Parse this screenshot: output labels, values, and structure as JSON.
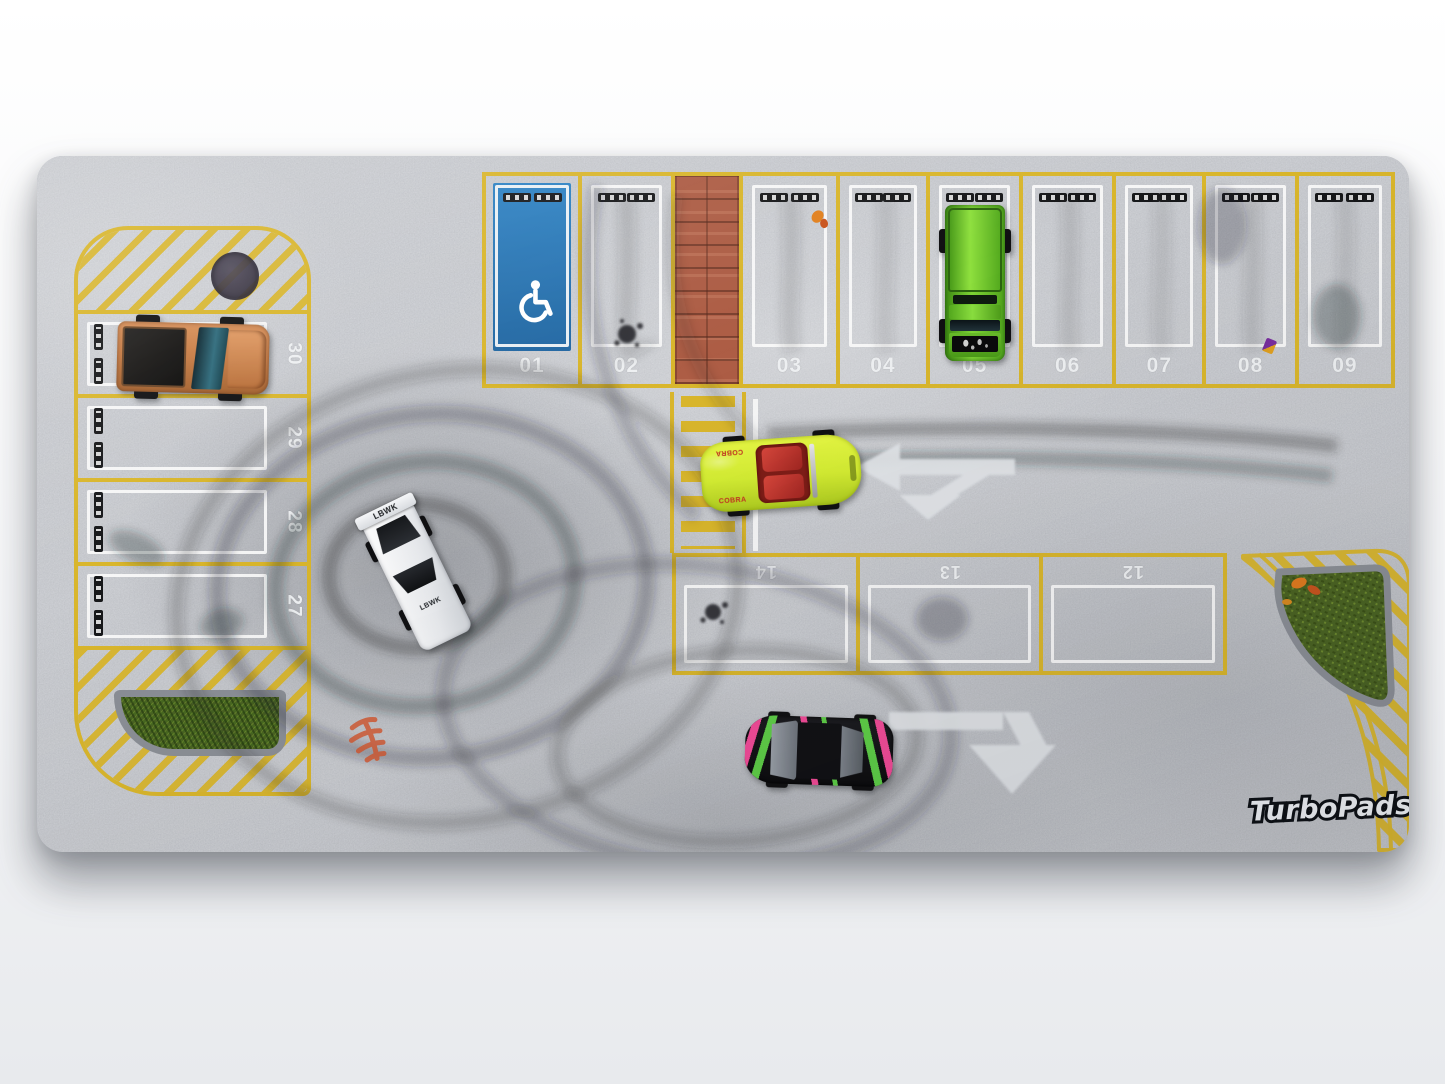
{
  "brand": {
    "logo": "TurboPads"
  },
  "spots": {
    "top_row": [
      "01",
      "02",
      "03",
      "04",
      "05",
      "06",
      "07",
      "08",
      "09"
    ],
    "middle_row": [
      "14",
      "13",
      "12"
    ],
    "left_column": [
      "30",
      "29",
      "28",
      "27"
    ]
  },
  "cars": {
    "copper_pickup": {
      "color": "copper",
      "parked_in_spot": "30"
    },
    "green_pickup": {
      "color": "metallic green",
      "parked_in_spot": "05"
    },
    "white_drift_car": {
      "color": "white",
      "roof_text": "LBWK",
      "hood_text": "LBWK"
    },
    "yellow_roadster": {
      "color": "neon yellow",
      "side_text": "COBRA",
      "interior_color": "red"
    },
    "black_hatchback": {
      "color": "black",
      "livery_colors": [
        "pink",
        "green"
      ]
    }
  },
  "features": {
    "accessible_spot": "01",
    "crosswalk": "yellow-striped crosswalk",
    "walkway": "brick pedestrian walkway",
    "grass_islands": 2,
    "manhole_covers": 1
  },
  "palette": {
    "asphalt": "#9aa0a7",
    "line_yellow": "#d9b62c",
    "line_white": "#eceff1",
    "accessible_blue": "#2a78b8",
    "brick": "#ad5d45",
    "grass": "#4a6322",
    "skid_mark": "#26282c",
    "car_copper": "#c77c44",
    "car_green": "#5cb822",
    "car_white": "#f2f3f5",
    "car_yellow": "#def23c",
    "car_black": "#141418",
    "livery_pink": "#ff4fa0",
    "livery_green": "#62d94a"
  }
}
